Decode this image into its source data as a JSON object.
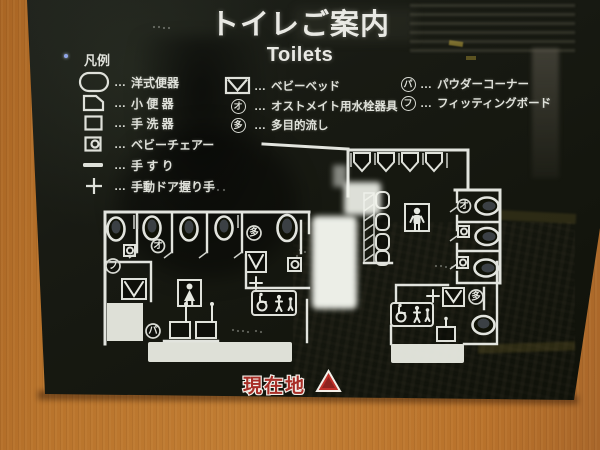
{
  "sign": {
    "title_jp": "トイレご案内",
    "title_en": "Toilets",
    "current_location": "現在地"
  },
  "legend": {
    "heading": "凡例",
    "ellipsis": "…",
    "left": [
      {
        "name": "western-toilet",
        "label": "洋式便器"
      },
      {
        "name": "urinal",
        "label": "小 便 器"
      },
      {
        "name": "hand-basin",
        "label": "手 洗 器"
      },
      {
        "name": "baby-chair",
        "label": "ベビーチェアー"
      },
      {
        "name": "handrail",
        "label": "手 す り"
      },
      {
        "name": "manual-door-handle",
        "label": "手動ドア握り手"
      }
    ],
    "middle": [
      {
        "name": "baby-bed",
        "label": "ベビーベッド",
        "symbol": ""
      },
      {
        "name": "ostomate-fixture",
        "label": "オストメイト用水栓器具",
        "symbol": "オ"
      },
      {
        "name": "multi-purpose-sink",
        "label": "多目的流し",
        "symbol": "多"
      }
    ],
    "right": [
      {
        "name": "powder-corner",
        "label": "パウダーコーナー",
        "symbol": "パ"
      },
      {
        "name": "fitting-board",
        "label": "フィッティングボード",
        "symbol": "フ"
      }
    ]
  },
  "map": {
    "symbols": {
      "fitting": "フ",
      "powder": "パ",
      "ostomate": "オ",
      "multi": "多"
    }
  },
  "colors": {
    "wall_orange": "#b9742c",
    "sign_black": "#14160e",
    "line_white": "#e2e4de",
    "location_red": "#a82e27"
  }
}
